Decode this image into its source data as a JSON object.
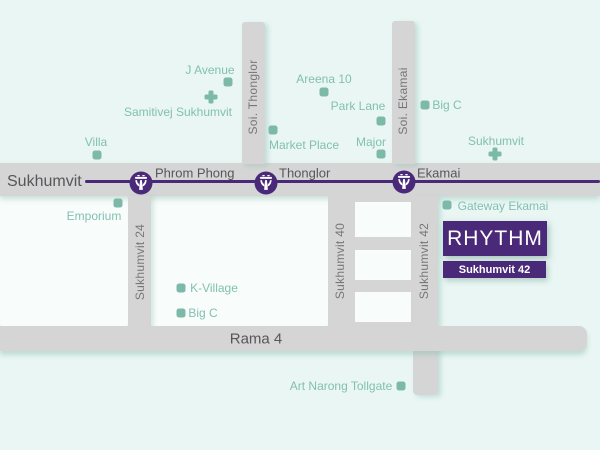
{
  "colors": {
    "bg": "#e9f6f3",
    "block": "#f8fcfb",
    "road": "#d5d5d5",
    "purple": "#4a2a78",
    "teal": "#7db9a9",
    "teal_text": "#82c0b0",
    "gray_text": "#57575b",
    "road_label": "#77777b"
  },
  "icons": {
    "station": "bts-train-icon",
    "poi_marker": "place-marker-square",
    "hospital": "hospital-cross-icon"
  },
  "main_road": {
    "label": "Sukhumvit"
  },
  "rama4": {
    "label": "Rama 4"
  },
  "stations": [
    {
      "slug": "phrom-phong",
      "label": "Phrom Phong",
      "cx": 141,
      "cy": 183,
      "lx": 155,
      "ly": 173
    },
    {
      "slug": "thonglor",
      "label": "Thonglor",
      "cx": 266,
      "cy": 183,
      "lx": 279,
      "ly": 173
    },
    {
      "slug": "ekamai",
      "label": "Ekamai",
      "cx": 404,
      "cy": 182,
      "lx": 417,
      "ly": 173
    }
  ],
  "vertical_roads": [
    {
      "slug": "soi-thonglor",
      "label": "Soi. Thonglor",
      "cx": 253,
      "cy": 97
    },
    {
      "slug": "soi-ekamai",
      "label": "Soi. Ekamai",
      "cx": 403,
      "cy": 101
    },
    {
      "slug": "sukhumvit-24",
      "label": "Sukhumvit 24",
      "cx": 140,
      "cy": 262
    },
    {
      "slug": "sukhumvit-40",
      "label": "Sukhumvit 40",
      "cx": 340,
      "cy": 261
    },
    {
      "slug": "sukhumvit-42",
      "label": "Sukhumvit 42",
      "cx": 424,
      "cy": 261
    }
  ],
  "pois": [
    {
      "slug": "j-avenue",
      "label": "J Avenue",
      "tx": 210,
      "ty": 70,
      "marker": "square",
      "mx": 228,
      "my": 82
    },
    {
      "slug": "samitivej-sukhumvit",
      "label": "Samitivej Sukhumvit",
      "tx": 178,
      "ty": 112,
      "marker": "cross",
      "mx": 211,
      "my": 97
    },
    {
      "slug": "villa",
      "label": "Villa",
      "tx": 96,
      "ty": 142,
      "marker": "square",
      "mx": 97,
      "my": 155
    },
    {
      "slug": "areena-10",
      "label": "Areena 10",
      "tx": 324,
      "ty": 79,
      "marker": "square",
      "mx": 324,
      "my": 92
    },
    {
      "slug": "park-lane",
      "label": "Park Lane",
      "tx": 358,
      "ty": 106,
      "marker": "square",
      "mx": 381,
      "my": 121
    },
    {
      "slug": "big-c-ekamai",
      "label": "Big C",
      "tx": 447,
      "ty": 105,
      "marker": "square",
      "mx": 425,
      "my": 105
    },
    {
      "slug": "market-place",
      "label": "Market Place",
      "tx": 304,
      "ty": 145,
      "marker": "square",
      "mx": 273,
      "my": 130
    },
    {
      "slug": "major",
      "label": "Major",
      "tx": 371,
      "ty": 142,
      "marker": "square",
      "mx": 381,
      "my": 154
    },
    {
      "slug": "sukhumvit-hospital",
      "label": "Sukhumvit",
      "tx": 496,
      "ty": 141,
      "marker": "cross",
      "mx": 495,
      "my": 154
    },
    {
      "slug": "emporium",
      "label": "Emporium",
      "tx": 94,
      "ty": 216,
      "marker": "square",
      "mx": 118,
      "my": 203
    },
    {
      "slug": "gateway-ekamai",
      "label": "Gateway Ekamai",
      "tx": 503,
      "ty": 206,
      "marker": "square",
      "mx": 447,
      "my": 205
    },
    {
      "slug": "k-village",
      "label": "K-Village",
      "tx": 214,
      "ty": 288,
      "marker": "square",
      "mx": 181,
      "my": 288
    },
    {
      "slug": "big-c-rama4",
      "label": "Big C",
      "tx": 203,
      "ty": 313,
      "marker": "square",
      "mx": 181,
      "my": 313
    },
    {
      "slug": "art-narong-tollgate",
      "label": "Art Narong Tollgate",
      "tx": 341,
      "ty": 386,
      "marker": "square",
      "mx": 401,
      "my": 386
    }
  ],
  "project": {
    "name": "RHYTHM",
    "sub": "Sukhumvit 42"
  }
}
